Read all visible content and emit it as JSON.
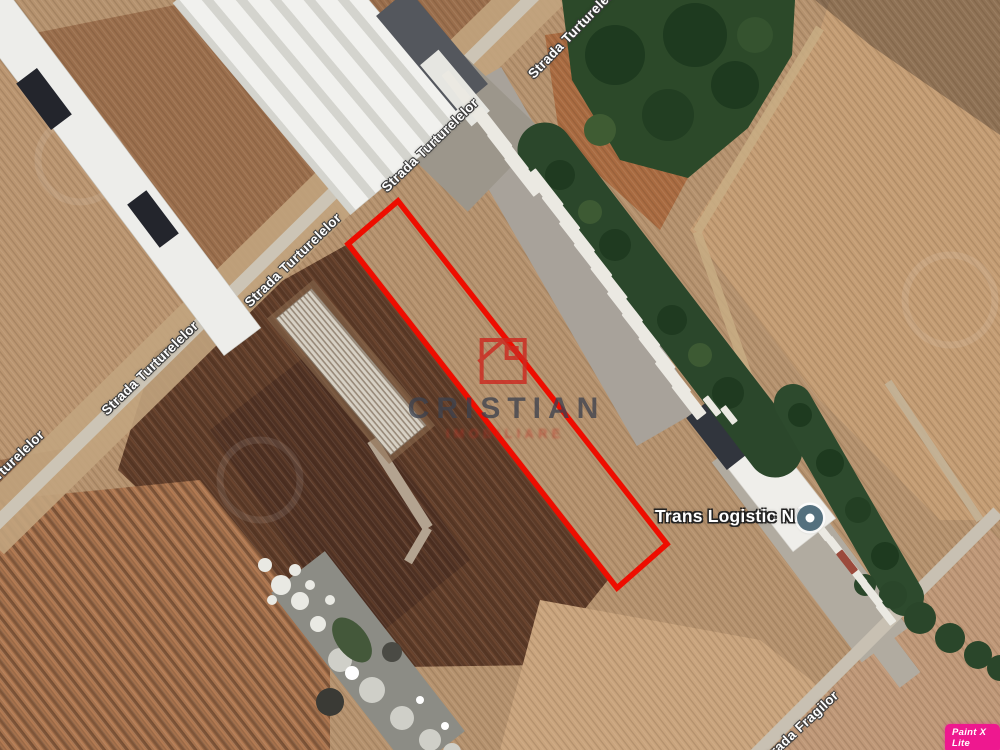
{
  "map": {
    "type": "satellite-imagery",
    "streets": {
      "main": "Strada Turturelelor",
      "secondary": "Strada Fragilor"
    },
    "poi": {
      "name": "Trans Logistic NAD",
      "marker_color": "#54707e"
    },
    "parcel_highlight": {
      "color": "#ee0d00",
      "points": [
        [
          398,
          201
        ],
        [
          667,
          544
        ],
        [
          617,
          588
        ],
        [
          348,
          244
        ]
      ]
    },
    "watermark": {
      "brand": "CRISTIAN",
      "subtitle": "IMOBILIARE",
      "logo_color": "#cc2a20"
    },
    "editor_badge": {
      "label": "Paint X Lite",
      "color": "#ee188f"
    },
    "colors": {
      "field_base": "#b5926e",
      "field_dark": "#5d3b28",
      "road": "#ccc4b5",
      "trees": "#2b472a",
      "warehouse_roof": "#efefec",
      "truck_trailer": "#ebe9e2"
    }
  }
}
